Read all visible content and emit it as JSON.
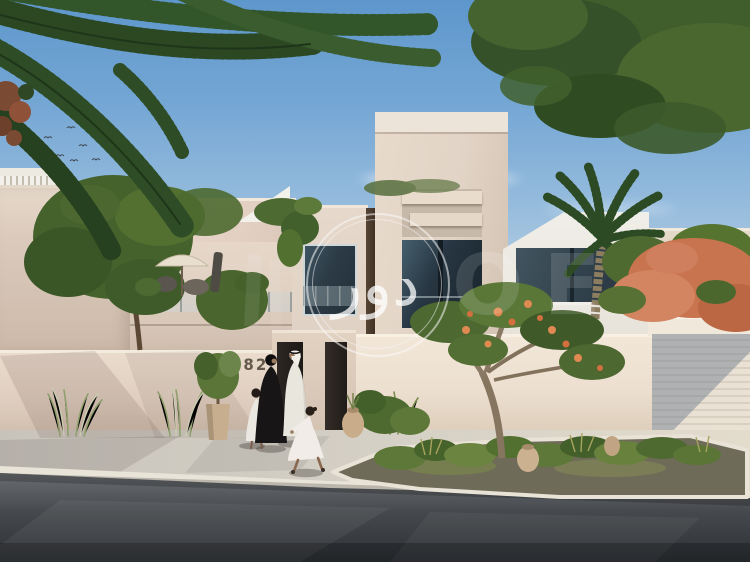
{
  "meta": {
    "width": 750,
    "height": 562,
    "kind": "architectural rendering / real-estate listing photo",
    "description": "Modern two-storey sand-coloured villa with central tower, boundary wall, garage, landscaped street island, Emirati family walking on the sidewalk, overhanging palm fronds and tree canopy, blue sky with a flock of birds"
  },
  "scene": {
    "villa": {
      "house_number": "682",
      "features": [
        "central-tower-with-louvre-fins",
        "dark-glass-windows",
        "roof-terrace-with-parasol-and-chairs",
        "dark-timber-entry-gate",
        "slatted-garage-door",
        "boundary-wall",
        "street-planting-island",
        "terracotta-urns"
      ]
    },
    "people": [
      {
        "id": "woman-in-black-abaya"
      },
      {
        "id": "man-in-white-kandura"
      },
      {
        "id": "girl-standing-white-dress"
      },
      {
        "id": "girl-running-white-dress"
      }
    ],
    "vegetation": [
      "palm-fronds-top-left",
      "tree-canopy-top-right",
      "garden-tree-left",
      "frangipani-tree-center",
      "date-palm-right",
      "coral-flowering-tree-right",
      "ornamental-grasses",
      "island-shrubs"
    ],
    "watermark": {
      "shape": "double-ring-circle-logo",
      "calligraphy": "دور",
      "faint_text": "OE"
    },
    "sky": {
      "birds_flock": true,
      "clouds": "wispy"
    }
  },
  "colors": {
    "sky_top": "#5e97cc",
    "sky_horizon": "#d7e1e7",
    "villa_wall": "#e3d5c8",
    "villa_cap": "#ece4d9",
    "boundary_wall_shaded": "#e2d3c5",
    "boundary_wall_lit": "#efe4d6",
    "glass_dark": "#273642",
    "gate_timber": "#26211e",
    "garage_door": "#e7dfd2",
    "sidewalk": "#d5d0c6",
    "road_dark": "#33373b",
    "palm_green": "#2c4a24",
    "canopy_green": "#42612e",
    "flower_coral": "#c8744f",
    "terracotta": "#c9ad8b",
    "abaya_black": "#181516",
    "kandura_white": "#e9e6de",
    "watermark_white": "#fafafa"
  }
}
